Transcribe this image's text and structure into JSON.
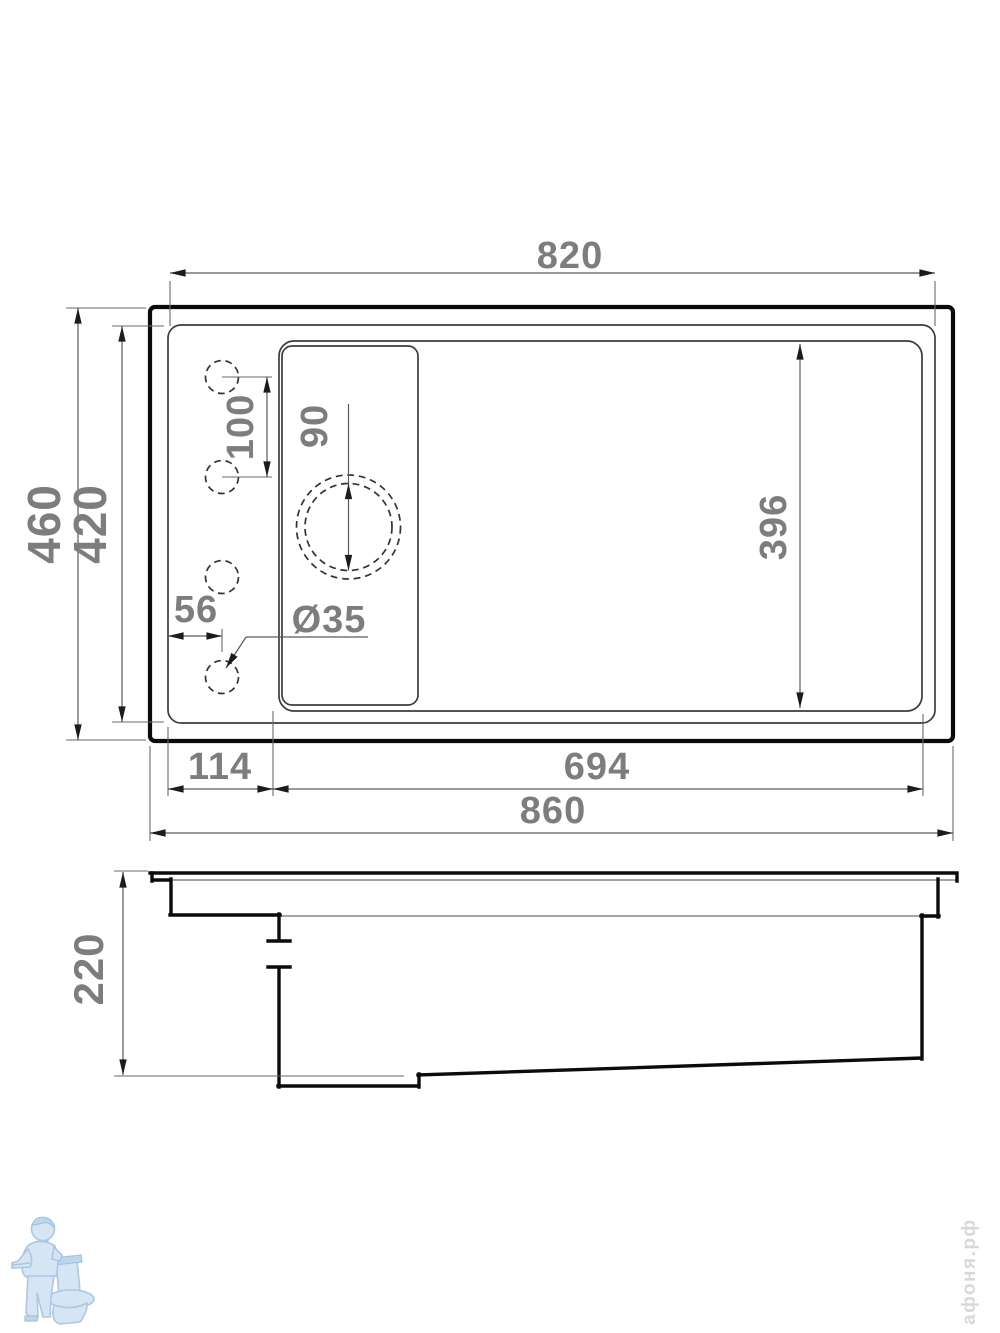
{
  "drawing": {
    "kind": "sink installation dimensional drawing",
    "views": {
      "top": {
        "dims": {
          "top_width": "820",
          "overall_width": "860",
          "overall_depth": "460",
          "cutout_depth": "420",
          "faucet_hole_spacing": "100",
          "faucet_hole_offset": "56",
          "faucet_hole_diameter": "Ø35",
          "drain_diameter": "90",
          "bowl_inner_depth": "396",
          "bowl_width": "694",
          "ledge_width": "114"
        }
      },
      "side": {
        "dims": {
          "overall_height": "220"
        }
      }
    }
  },
  "watermark": {
    "brand": "афоня.рф",
    "logo": "plumber-with-toilet"
  },
  "colors": {
    "dimension_text": "#7d7d7d",
    "outline": "#0b0b0b",
    "thin_line": "#3c3c3c",
    "dim_line": "#5a5a5a",
    "logo_blue": "#bed6ec",
    "watermark_text": "#d9d9d9"
  }
}
